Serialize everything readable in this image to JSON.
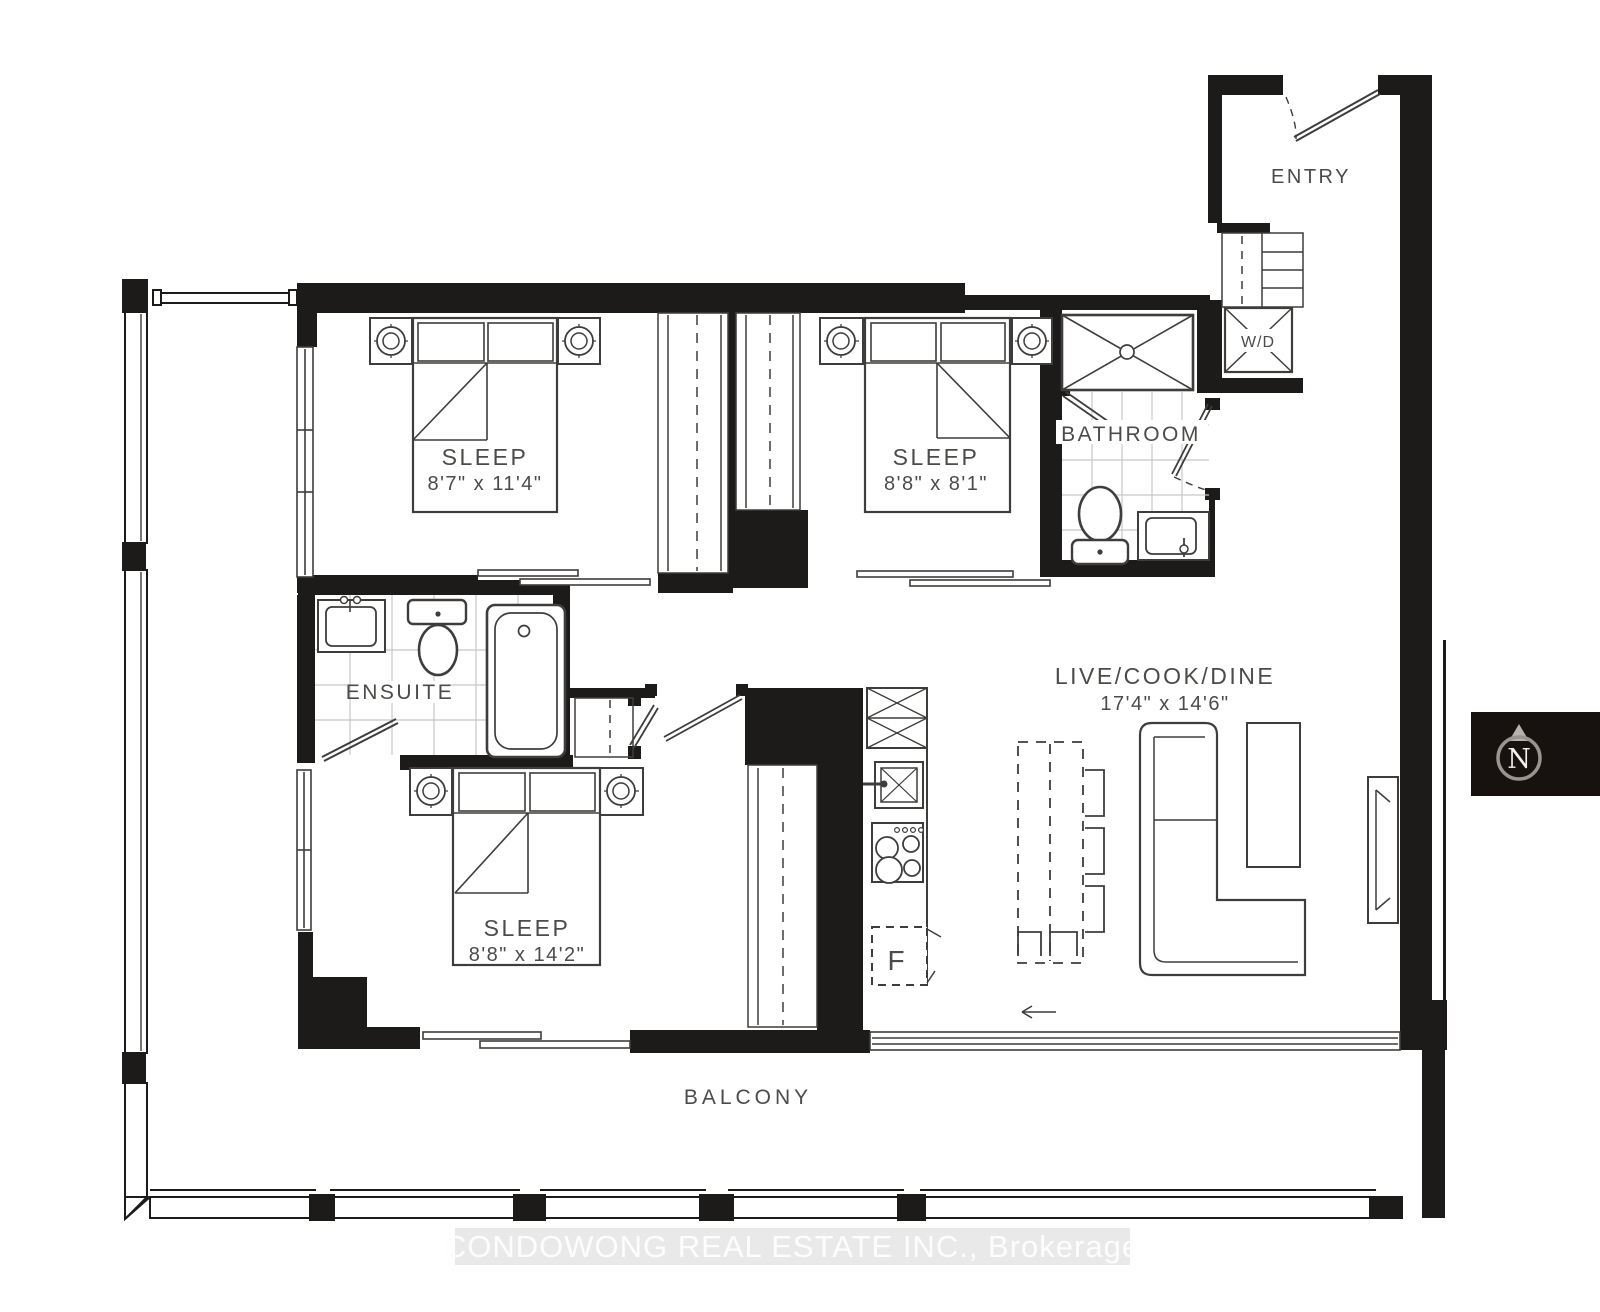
{
  "rooms": {
    "sleep1": {
      "label": "SLEEP",
      "dims": "8'7\" x 11'4\""
    },
    "sleep2": {
      "label": "SLEEP",
      "dims": "8'8\" x 8'1\""
    },
    "sleep3": {
      "label": "SLEEP",
      "dims": "8'8\" x 14'2\""
    },
    "live": {
      "label": "LIVE/COOK/DINE",
      "dims": "17'4\" x 14'6\""
    },
    "entry": {
      "label": "ENTRY"
    },
    "bathroom": {
      "label": "BATHROOM"
    },
    "ensuite": {
      "label": "ENSUITE"
    },
    "balcony": {
      "label": "BALCONY"
    }
  },
  "fixtures": {
    "washer_dryer": "W/D",
    "fridge": "F"
  },
  "compass": {
    "north": "N"
  },
  "watermark": {
    "text": "CONDOWONG REAL ESTATE INC., Brokerage"
  },
  "colors": {
    "wall": "#1d1b19",
    "furniture_line": "#3e3d3c",
    "tile_line": "#c7c7c7",
    "label_text": "#4c4b49",
    "watermark_bg": "#e7e7e7",
    "watermark_text": "#fdfdfd",
    "compass_bg": "#171110",
    "compass_ring": "#989490"
  }
}
